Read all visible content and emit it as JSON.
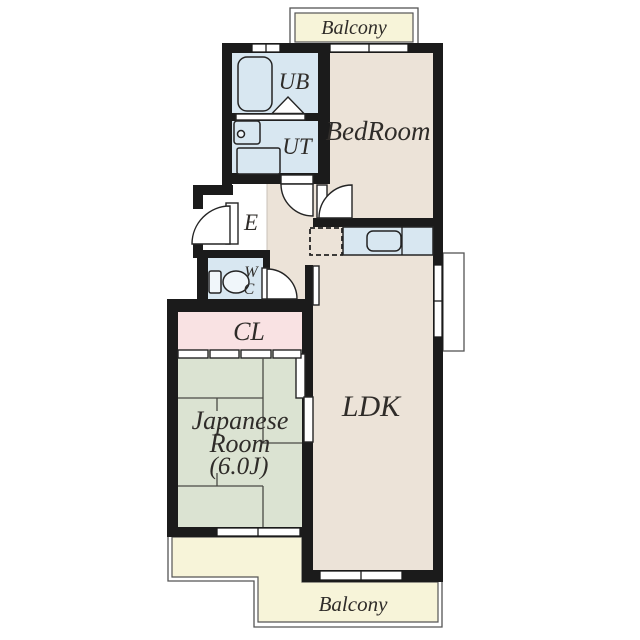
{
  "floorplan": {
    "labels": {
      "balcony_top": "Balcony",
      "unit_bath": "UB",
      "utility": "UT",
      "bedroom": "BedRoom",
      "entrance": "E",
      "wc_line1": "W",
      "wc_line2": "C",
      "closet": "CL",
      "japanese_room_line1": "Japanese",
      "japanese_room_line2": "Room",
      "japanese_room_line3": "(6.0J)",
      "ldk": "LDK",
      "balcony_bottom": "Balcony"
    },
    "colors": {
      "wall": "#1b1b1b",
      "outline": "#242424",
      "room-beige": "#ece3d8",
      "room-blue": "#d8e7f1",
      "room-pink": "#f9e2e3",
      "room-green": "#dbe3d2",
      "balcony-cream": "#f7f4d9",
      "thin-line": "#555555",
      "label": "#2f2c29"
    }
  }
}
